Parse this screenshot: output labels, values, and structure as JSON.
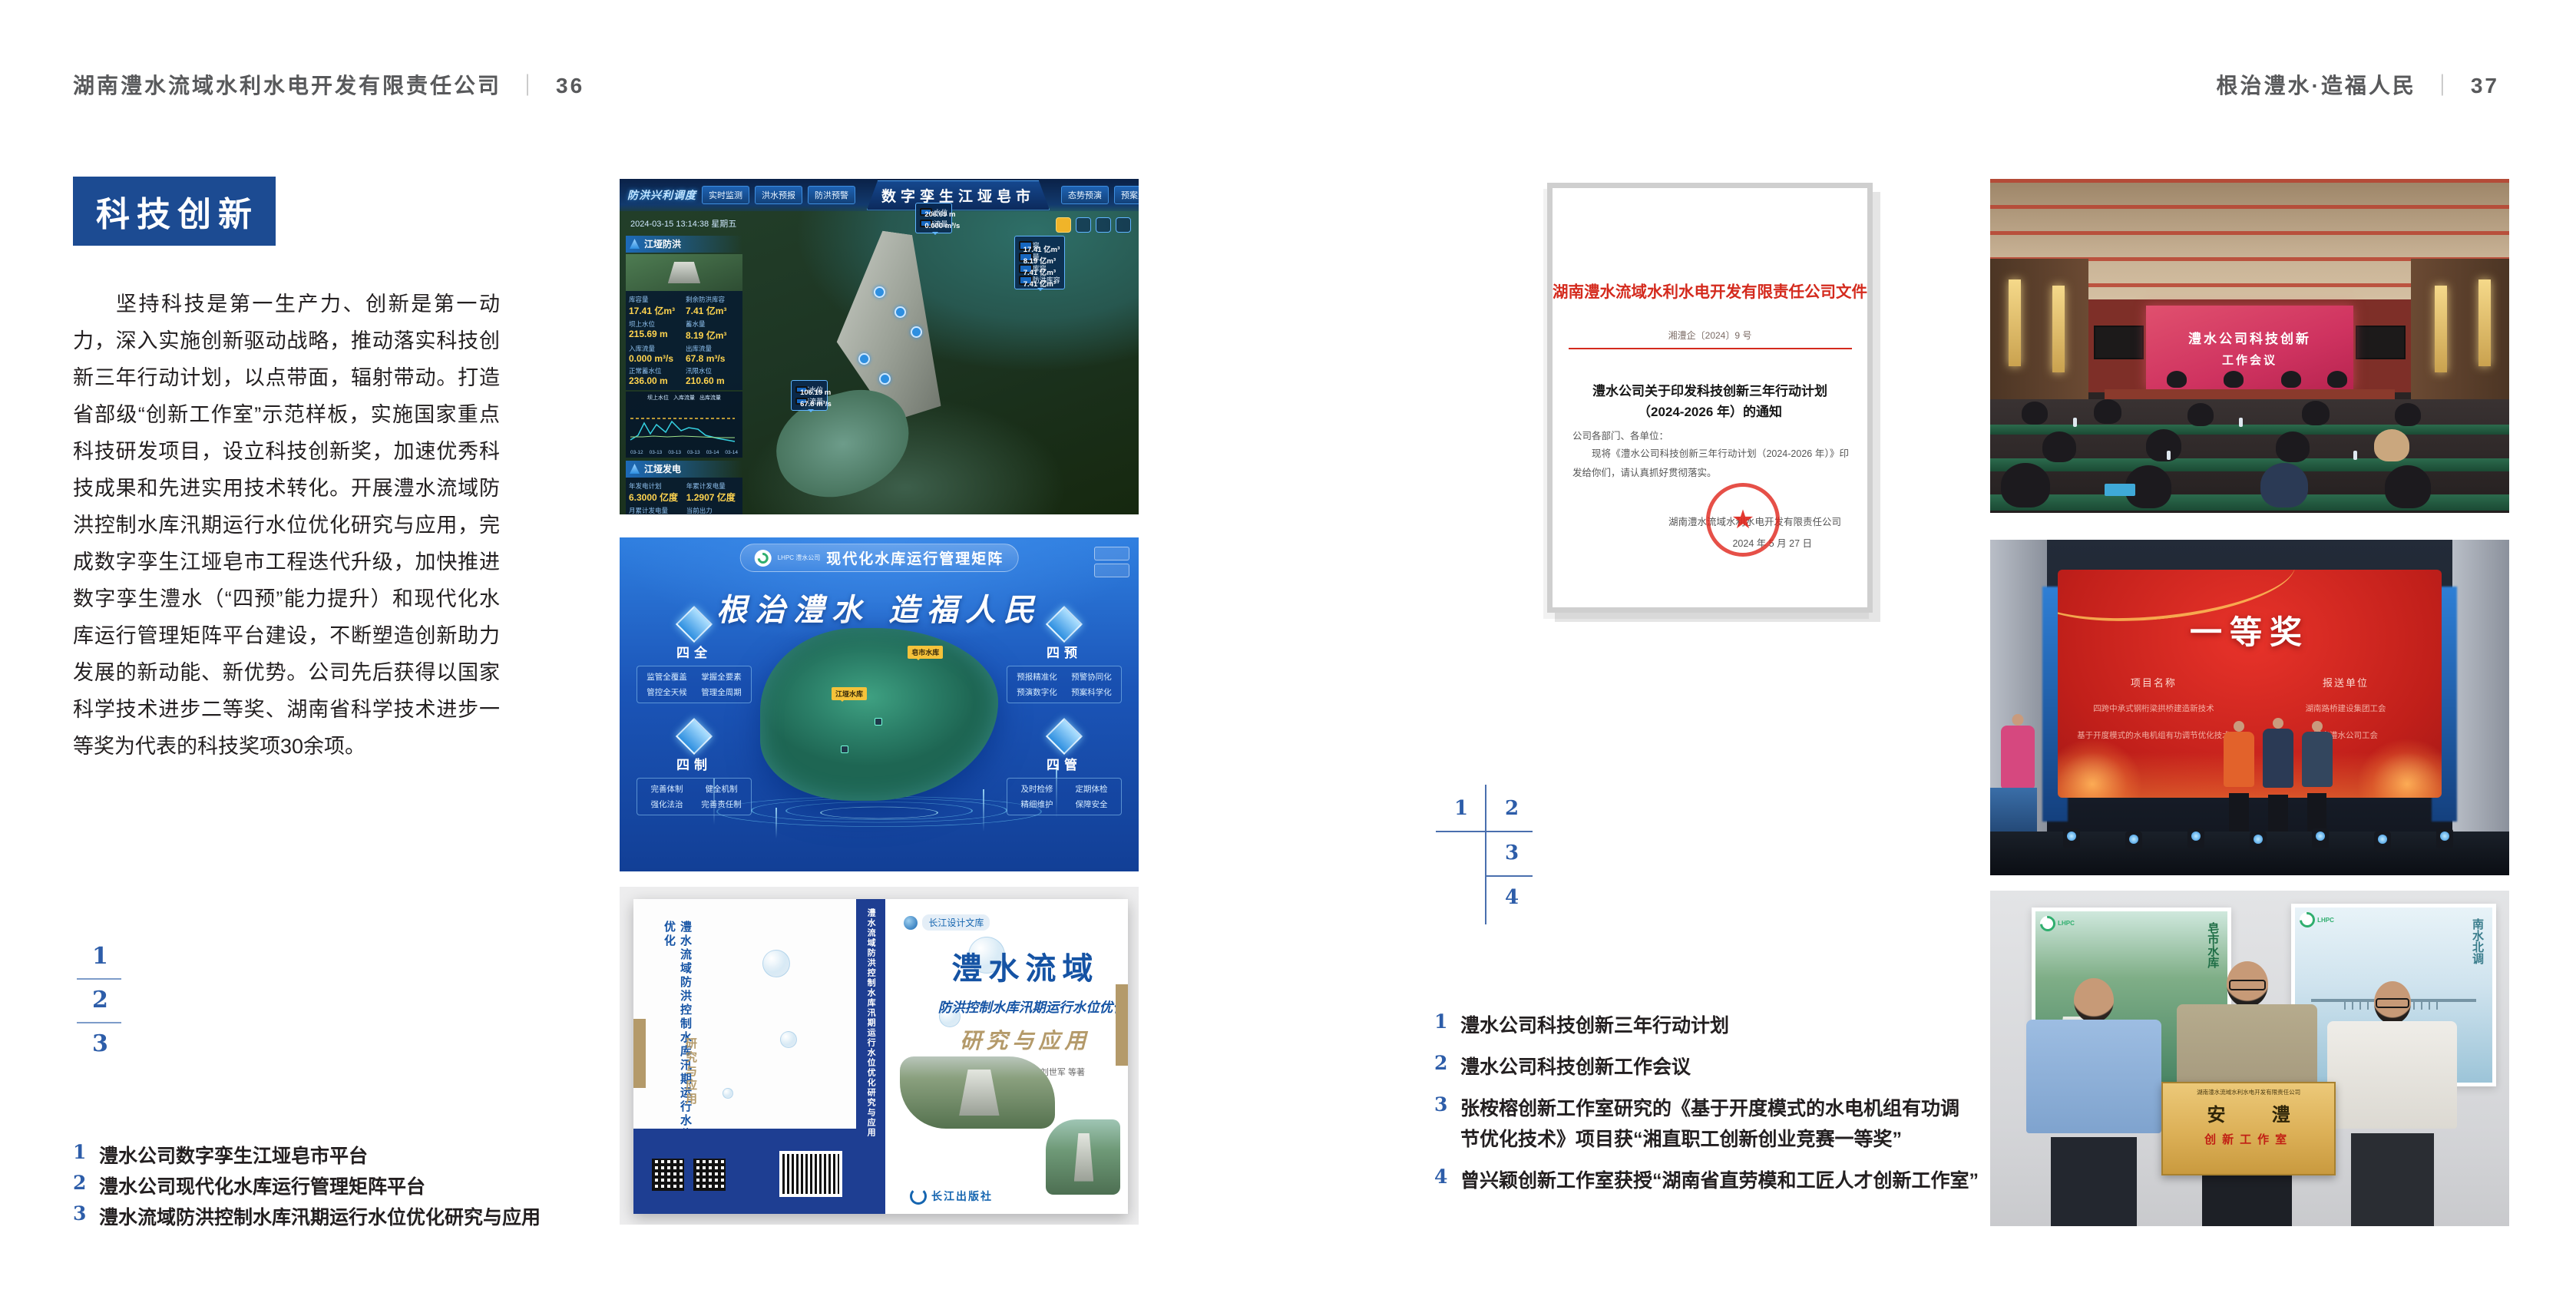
{
  "page_left": {
    "header": {
      "company": "湖南澧水流域水利水电开发有限责任公司",
      "divider": "｜",
      "page_number": "36"
    },
    "badge": "科技创新",
    "paragraph": "坚持科技是第一生产力、创新是第一动力，深入实施创新驱动战略，推动落实科技创新三年行动计划，以点带面，辐射带动。打造省部级“创新工作室”示范样板，实施国家重点科技研发项目，设立科技创新奖，加速优秀科技成果和先进实用技术转化。开展澧水流域防洪控制水库汛期运行水位优化研究与应用，完成数字孪生江垭皂市工程迭代升级，加快推进数字孪生澧水（“四预”能力提升）和现代化水库运行管理矩阵平台建设，不断塑造创新助力发展的新动能、新优势。公司先后获得以国家科学技术进步二等奖、湖南省科学技术进步一等奖为代表的科技奖项30余项。",
    "figure_index": [
      "1",
      "2",
      "3"
    ],
    "captions": [
      {
        "num": "1",
        "text": "澧水公司数字孪生江垭皂市平台"
      },
      {
        "num": "2",
        "text": "澧水公司现代化水库运行管理矩阵平台"
      },
      {
        "num": "3",
        "text": "澧水流域防洪控制水库汛期运行水位优化研究与应用"
      }
    ]
  },
  "page_right": {
    "header": {
      "slogan": "根治澧水·造福人民",
      "divider": "｜",
      "page_number": "37"
    },
    "figure_index": [
      "1",
      "2",
      "3",
      "4"
    ],
    "captions": [
      {
        "num": "1",
        "text": "澧水公司科技创新三年行动计划"
      },
      {
        "num": "2",
        "text": "澧水公司科技创新工作会议"
      },
      {
        "num": "3",
        "text": "张桉榕创新工作室研究的《基于开度模式的水电机组有功调节优化技术》项目获“湘直职工创新创业竞赛一等奖”"
      },
      {
        "num": "4",
        "text": "曾兴颖创新工作室获授“湖南省直劳模和工匠人才创新工作室”"
      }
    ]
  },
  "document": {
    "red_title": "湖南澧水流域水利水电开发有限责任公司文件",
    "doc_number": "湘澧企〔2024〕9 号",
    "notice_title_line1": "澧水公司关于印发科技创新三年行动计划",
    "notice_title_line2": "（2024-2026 年）的通知",
    "salutation": "公司各部门、各单位：",
    "body": "现将《澧水公司科技创新三年行动计划（2024-2026 年）》印发给你们，请认真抓好贯彻落实。",
    "signature": "湖南澧水流域水利水电开发有限责任公司",
    "date": "2024 年 5 月 27 日",
    "seal_star": "★"
  },
  "dashboard": {
    "brand": "防洪兴利调度",
    "title": "数字孪生江垭皂市",
    "tabs_left": [
      "实时监测",
      "洪水预报",
      "防洪预警"
    ],
    "tabs_right": [
      "态势预演",
      "预案生成",
      "调度执行",
      "工程导览"
    ],
    "timestamp": "2024-03-15 13:14:38 星期五",
    "panel_flood": {
      "title": "江垭防洪",
      "stats": [
        {
          "label": "库容量",
          "value": "17.41 亿m³"
        },
        {
          "label": "剩余防洪库容",
          "value": "7.41 亿m³"
        },
        {
          "label": "坝上水位",
          "value": "215.69 m"
        },
        {
          "label": "蓄水量",
          "value": "8.19 亿m³"
        },
        {
          "label": "入库流量",
          "value": "0.000 m³/s"
        },
        {
          "label": "出库流量",
          "value": "67.8 m³/s"
        },
        {
          "label": "正常蓄水位",
          "value": "236.00 m"
        },
        {
          "label": "汛限水位",
          "value": "210.60 m"
        }
      ],
      "chart_legend": [
        "坝上水位",
        "入库流量",
        "出库流量"
      ],
      "chart_x": [
        "03-12",
        "03-13",
        "03-13",
        "03-13",
        "03-14",
        "03-14"
      ]
    },
    "panel_power": {
      "title": "江垭发电",
      "stats": [
        {
          "label": "年发电计划",
          "value": "6.3000 亿度"
        },
        {
          "label": "年累计发电量",
          "value": "1.2907 亿度"
        },
        {
          "label": "月累计发电量",
          "value": "3359.21 万度"
        },
        {
          "label": "当前出力",
          "value": "0.00 MW"
        },
        {
          "label": "发电流量",
          "value": "0.00 m³/s"
        },
        {
          "label": "弃水流量",
          "value": "0.00 m³/s"
        }
      ],
      "units": [
        "1号机组",
        "2号机组",
        "3号机组"
      ]
    },
    "tags": {
      "upstream": [
        {
          "label": "坝上水位",
          "value": "206.69 m"
        },
        {
          "label": "入库流量",
          "value": "0.000 m³/s"
        }
      ],
      "capacity": [
        {
          "label": "总库容",
          "value": "17.41 亿m³"
        },
        {
          "label": "蓄水量",
          "value": "8.19 亿m³"
        },
        {
          "label": "防洪库容",
          "value": "7.41 亿m³"
        },
        {
          "label": "剩余防洪库容",
          "value": "7.41 亿m³"
        }
      ],
      "downstream": [
        {
          "label": "坝下水位",
          "value": "106.19 m"
        },
        {
          "label": "出库流量",
          "value": "67.8 m³/s"
        }
      ]
    }
  },
  "matrix": {
    "logo_text": "LHPC 澧水公司",
    "title": "现代化水库运行管理矩阵",
    "slogan": "根治澧水 造福人民",
    "markers": [
      "皂市水库",
      "江垭水库"
    ],
    "nodes": [
      {
        "name": "四全",
        "items": [
          "监管全覆盖",
          "掌握全要素",
          "管控全天候",
          "管理全周期"
        ]
      },
      {
        "name": "四预",
        "items": [
          "预报精准化",
          "预警协同化",
          "预演数字化",
          "预案科学化"
        ]
      },
      {
        "name": "四制",
        "items": [
          "完善体制",
          "健全机制",
          "强化法治",
          "完善责任制"
        ]
      },
      {
        "name": "四管",
        "items": [
          "及时检修",
          "定期体检",
          "精细维护",
          "保障安全"
        ]
      }
    ]
  },
  "book": {
    "library": "长江设计文库",
    "title_main": "澧水流域",
    "title_sub": "防洪控制水库汛期运行水位优化",
    "title_tail": "研究与应用",
    "authors": "洪兴骏  沈坤民  鲁军  刘世军  等著",
    "publisher": "长江出版社",
    "spine_text": "澧水流域防洪控制水库汛期运行水位优化研究与应用",
    "back_title": "澧水流域防洪控制水库汛期运行水位优化",
    "back_tail": "研究与应用"
  },
  "meeting": {
    "screen_line1": "澧水公司科技创新",
    "screen_line2": "工作会议"
  },
  "award": {
    "title": "一等奖",
    "col1": "项目名称",
    "col2": "报送单位",
    "rows": [
      {
        "project": "四跨中承式钢桁梁拱桥建造新技术",
        "org": "湖南路桥建设集团工会"
      },
      {
        "project": "基于开度模式的水电机组有功调节优化技术",
        "org": "湖南澧水公司工会"
      }
    ]
  },
  "plaque": {
    "logo": "LHPC",
    "poster_left_text": "皂市水库",
    "poster_right_text": "南水北调",
    "plate_header": "湖南澧水流域水利水电开发有限责任公司",
    "plate_title": "安 澧",
    "plate_subtitle": "创新工作室"
  },
  "colors": {
    "badge_blue": "#1c4b92",
    "index_blue": "#2d5da9",
    "header_gray": "#58595b",
    "doc_red": "#d42a1d",
    "book_navy": "#1e3e92",
    "gold": "#b49a6a",
    "meeting_screen_pink": "#cf3360",
    "award_red": "#c01f1a"
  }
}
